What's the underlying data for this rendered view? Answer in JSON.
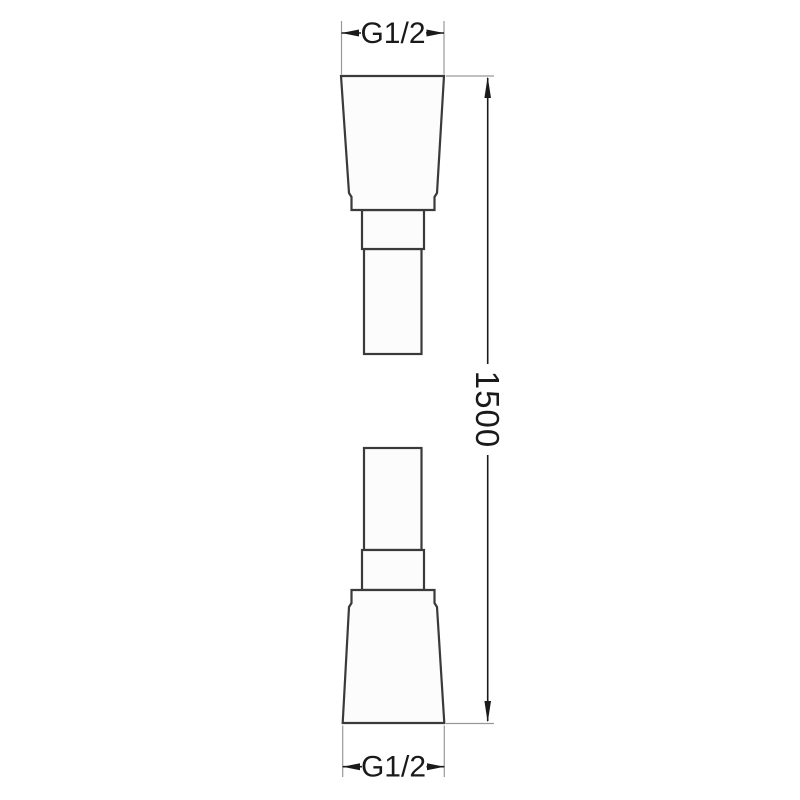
{
  "drawing": {
    "kind": "technical-dimension-drawing",
    "labels": {
      "top_thread": "G1/2",
      "length": "1500",
      "bottom_thread": "G1/2"
    },
    "colors": {
      "background": "#ffffff",
      "shape_outline": "#3a3a3a",
      "shape_fill": "#fcfcfc",
      "dimension_line": "#1a1a1a",
      "extension_line": "#999999",
      "text": "#1a1a1a"
    }
  }
}
